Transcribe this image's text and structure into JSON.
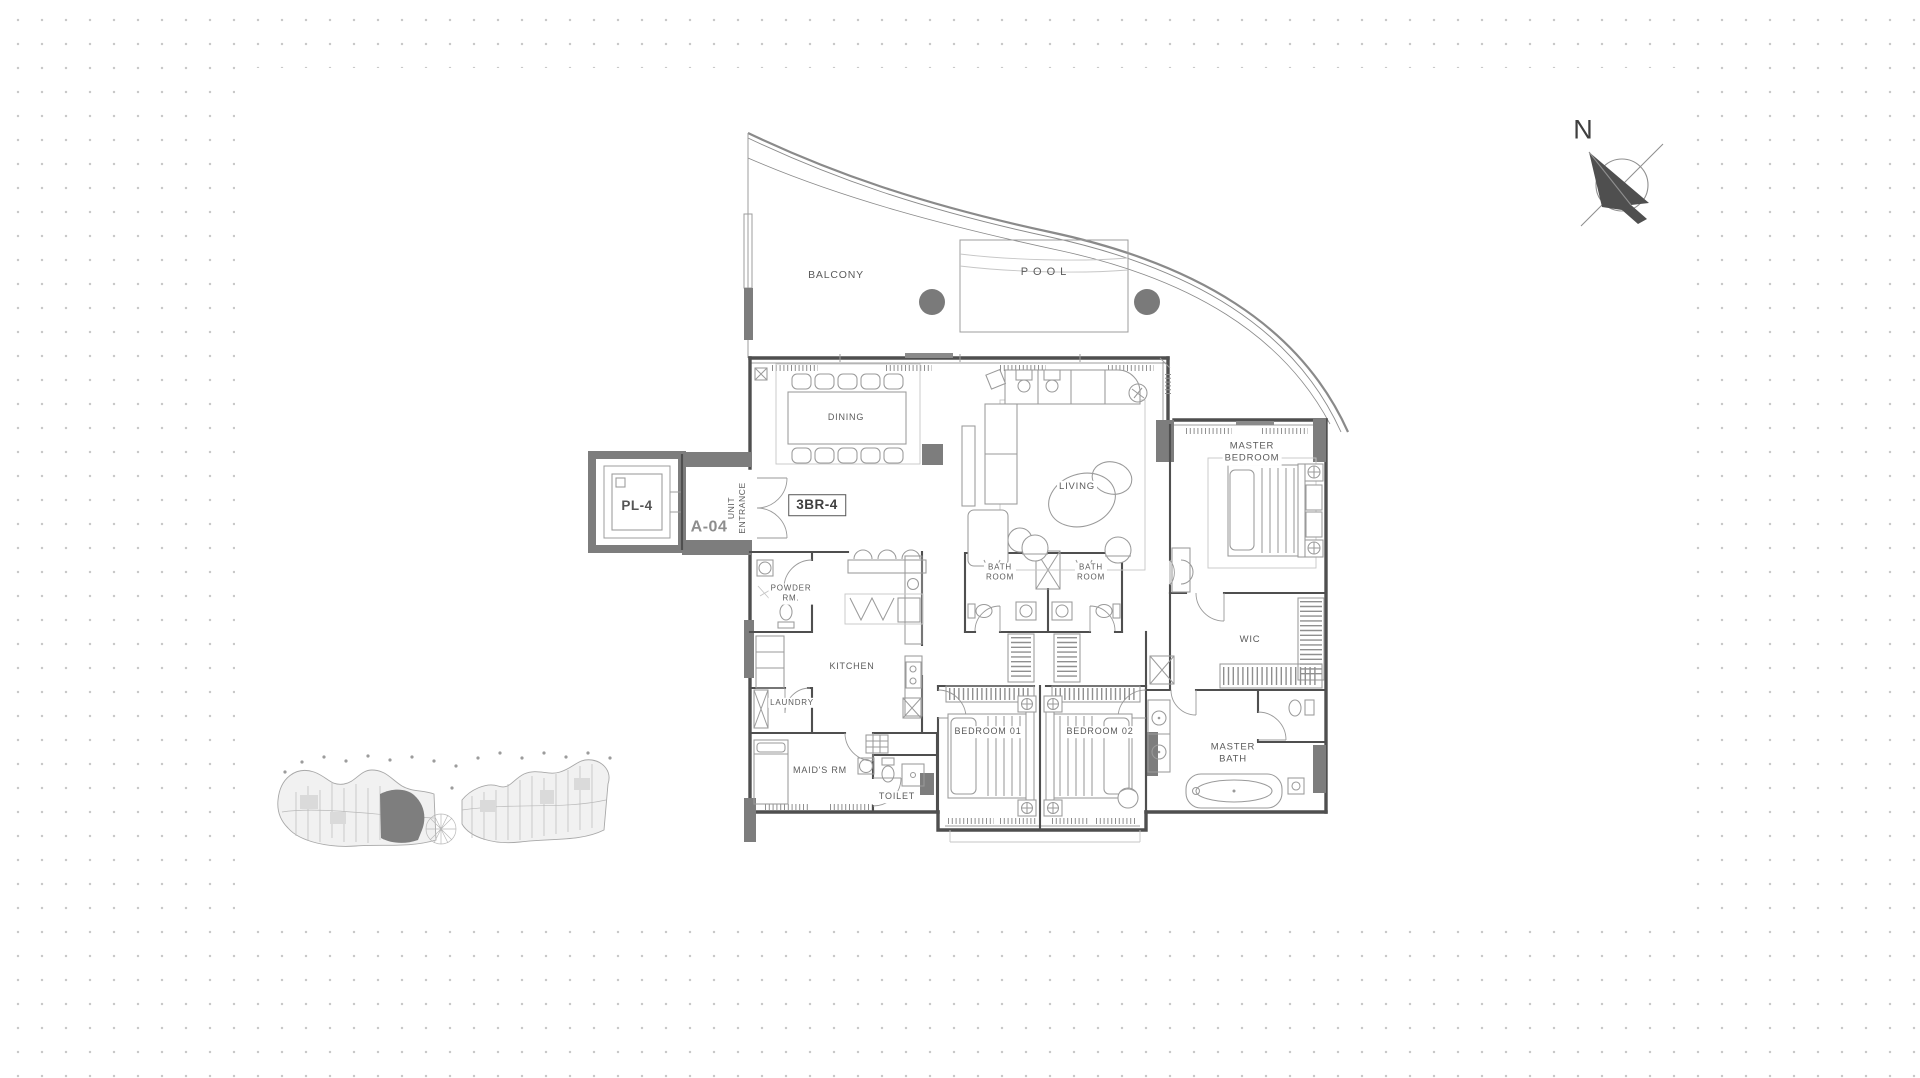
{
  "meta": {
    "drawing_type": "residential unit floor plan",
    "unit_type": "3BR-4",
    "unit_number": "A-04"
  },
  "colors": {
    "wall": "#4f4f4f",
    "poche": "#7d7d7d",
    "furniture": "#9a9a9a",
    "light": "#c6c6c6",
    "text": "#5b5b5b",
    "dots": "#c9c9c9",
    "paper": "#ffffff"
  },
  "labels": {
    "balcony": "BALCONY",
    "pool": "POOL",
    "dining": "DINING",
    "living": "LIVING",
    "master_bedroom": [
      "MASTER",
      "BEDROOM"
    ],
    "unit_entrance": [
      "UNIT",
      "ENTRANCE"
    ],
    "unit_type": "3BR-4",
    "unit_number": "A-04",
    "elevator": "PL-4",
    "powder_room": [
      "POWDER",
      "RM."
    ],
    "kitchen": "KITCHEN",
    "laundry": "LAUNDRY",
    "bathroom_1": [
      "BATH",
      "ROOM"
    ],
    "bathroom_2": [
      "BATH",
      "ROOM"
    ],
    "wic": "WIC",
    "bedroom_1": "BEDROOM 01",
    "bedroom_2": "BEDROOM 02",
    "maids_room": "MAID'S RM",
    "toilet": "TOILET",
    "master_bath": [
      "MASTER",
      "BATH"
    ],
    "north": "N"
  }
}
